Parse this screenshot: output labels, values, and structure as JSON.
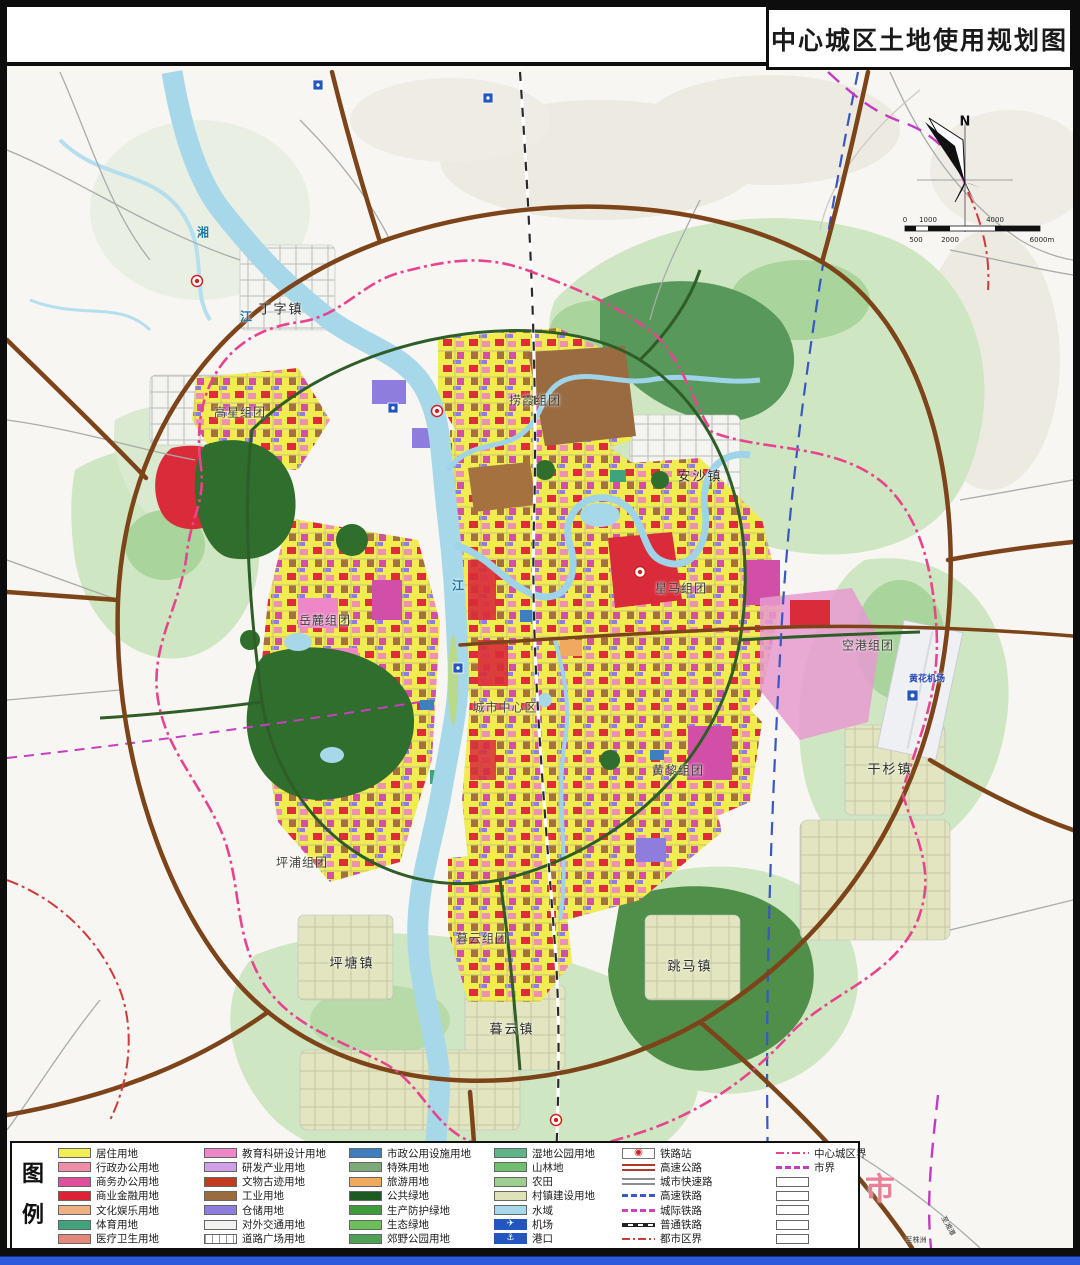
{
  "title": "中心城区土地使用规划图",
  "legend": {
    "heading": "图例",
    "columns": [
      {
        "items": [
          {
            "label": "居住用地",
            "swatch": "fill",
            "color": "#f2ef52"
          },
          {
            "label": "行政办公用地",
            "swatch": "fill",
            "color": "#ef8ea6"
          },
          {
            "label": "商务办公用地",
            "swatch": "fill",
            "color": "#e04f9e"
          },
          {
            "label": "商业金融用地",
            "swatch": "fill",
            "color": "#dd2235"
          },
          {
            "label": "文化娱乐用地",
            "swatch": "fill",
            "color": "#efb183"
          },
          {
            "label": "体育用地",
            "swatch": "fill",
            "color": "#3fa47c"
          },
          {
            "label": "医疗卫生用地",
            "swatch": "fill",
            "color": "#e4877d"
          }
        ]
      },
      {
        "items": [
          {
            "label": "教育科研设计用地",
            "swatch": "fill",
            "color": "#ee86c8"
          },
          {
            "label": "研发产业用地",
            "swatch": "fill",
            "color": "#cf9fe8"
          },
          {
            "label": "文物古迹用地",
            "swatch": "fill",
            "color": "#c23a20"
          },
          {
            "label": "工业用地",
            "swatch": "fill",
            "color": "#9a6b41"
          },
          {
            "label": "仓储用地",
            "swatch": "fill",
            "color": "#8f7ddd"
          },
          {
            "label": "对外交通用地",
            "swatch": "fill",
            "color": "#f2f2f0"
          },
          {
            "label": "道路广场用地",
            "swatch": "hatch",
            "color": "#f2f2f0"
          }
        ]
      },
      {
        "items": [
          {
            "label": "市政公用设施用地",
            "swatch": "fill",
            "color": "#3e7fc1"
          },
          {
            "label": "特殊用地",
            "swatch": "fill",
            "color": "#7da878"
          },
          {
            "label": "旅游用地",
            "swatch": "fill",
            "color": "#f0a95e"
          },
          {
            "label": "公共绿地",
            "swatch": "fill",
            "color": "#1e5b20"
          },
          {
            "label": "生产防护绿地",
            "swatch": "fill",
            "color": "#3f9c3a"
          },
          {
            "label": "生态绿地",
            "swatch": "fill",
            "color": "#6cbf57"
          },
          {
            "label": "郊野公园用地",
            "swatch": "fill",
            "color": "#4f9f55"
          }
        ]
      },
      {
        "items": [
          {
            "label": "湿地公园用地",
            "swatch": "fill",
            "color": "#5cb586"
          },
          {
            "label": "山林地",
            "swatch": "fill",
            "color": "#6fbf6f"
          },
          {
            "label": "农田",
            "swatch": "fill",
            "color": "#9ccf8f"
          },
          {
            "label": "村镇建设用地",
            "swatch": "fill",
            "color": "#dfe2b8"
          },
          {
            "label": "水域",
            "swatch": "fill",
            "color": "#a6d8ea"
          },
          {
            "label": "机场",
            "swatch": "icon-airport",
            "color": "#2456c0"
          },
          {
            "label": "港口",
            "swatch": "icon-port",
            "color": "#2456c0"
          }
        ]
      },
      {
        "items": [
          {
            "label": "铁路站",
            "swatch": "icon-station",
            "color": "#cc2222"
          },
          {
            "label": "高速公路",
            "swatch": "line-double",
            "color": "#b03a2e"
          },
          {
            "label": "城市快速路",
            "swatch": "line-double",
            "color": "#8a8f93"
          },
          {
            "label": "高速铁路",
            "swatch": "dash",
            "color": "#3a57c4"
          },
          {
            "label": "城际铁路",
            "swatch": "dash",
            "color": "#cc44bb"
          },
          {
            "label": "普通铁路",
            "swatch": "rail",
            "color": "#222222"
          },
          {
            "label": "都市区界",
            "swatch": "dashdot",
            "color": "#d03a3a"
          }
        ]
      },
      {
        "items": [
          {
            "label": "中心城区界",
            "swatch": "dashdot",
            "color": "#e8448e"
          },
          {
            "label": "市界",
            "swatch": "dash",
            "color": "#c23bc2"
          },
          {
            "label": "",
            "swatch": "empty",
            "color": "#ffffff"
          },
          {
            "label": "",
            "swatch": "empty",
            "color": "#ffffff"
          },
          {
            "label": "",
            "swatch": "empty",
            "color": "#ffffff"
          },
          {
            "label": "",
            "swatch": "empty",
            "color": "#ffffff"
          },
          {
            "label": "",
            "swatch": "empty",
            "color": "#ffffff"
          }
        ]
      }
    ]
  },
  "map_labels": [
    {
      "text": "丁字镇",
      "x": 281,
      "y": 308,
      "kind": "town"
    },
    {
      "text": "高星组团",
      "x": 240,
      "y": 412,
      "kind": "cluster"
    },
    {
      "text": "捞霞组团",
      "x": 535,
      "y": 400,
      "kind": "cluster"
    },
    {
      "text": "安沙镇",
      "x": 700,
      "y": 475,
      "kind": "town"
    },
    {
      "text": "岳麓组团",
      "x": 325,
      "y": 620,
      "kind": "cluster"
    },
    {
      "text": "星马组团",
      "x": 681,
      "y": 588,
      "kind": "cluster"
    },
    {
      "text": "城市中心区",
      "x": 505,
      "y": 707,
      "kind": "center"
    },
    {
      "text": "黄黎组团",
      "x": 678,
      "y": 770,
      "kind": "cluster"
    },
    {
      "text": "空港组团",
      "x": 868,
      "y": 645,
      "kind": "cluster"
    },
    {
      "text": "黄花机场",
      "x": 927,
      "y": 678,
      "kind": "airport"
    },
    {
      "text": "干杉镇",
      "x": 890,
      "y": 768,
      "kind": "town"
    },
    {
      "text": "坪浦组团",
      "x": 302,
      "y": 862,
      "kind": "cluster"
    },
    {
      "text": "暮云组团",
      "x": 482,
      "y": 938,
      "kind": "cluster"
    },
    {
      "text": "坪塘镇",
      "x": 352,
      "y": 962,
      "kind": "town"
    },
    {
      "text": "跳马镇",
      "x": 690,
      "y": 965,
      "kind": "town"
    },
    {
      "text": "暮云镇",
      "x": 512,
      "y": 1028,
      "kind": "town"
    },
    {
      "text": "湘",
      "x": 203,
      "y": 232,
      "kind": "river"
    },
    {
      "text": "江",
      "x": 246,
      "y": 316,
      "kind": "river"
    },
    {
      "text": "江",
      "x": 458,
      "y": 585,
      "kind": "river"
    },
    {
      "text": "市",
      "x": 880,
      "y": 1186,
      "kind": "city"
    },
    {
      "text": "N",
      "x": 965,
      "y": 122,
      "kind": "compass"
    },
    {
      "text": "0",
      "x": 905,
      "y": 220,
      "kind": "scale"
    },
    {
      "text": "1000",
      "x": 928,
      "y": 220,
      "kind": "scale"
    },
    {
      "text": "4000",
      "x": 995,
      "y": 220,
      "kind": "scale"
    },
    {
      "text": "500",
      "x": 916,
      "y": 240,
      "kind": "scale"
    },
    {
      "text": "2000",
      "x": 950,
      "y": 240,
      "kind": "scale"
    },
    {
      "text": "6000m",
      "x": 1042,
      "y": 240,
      "kind": "scale"
    },
    {
      "text": "至株洲",
      "x": 916,
      "y": 1240,
      "kind": "tiny"
    },
    {
      "text": "至湘潭",
      "x": 948,
      "y": 1226,
      "kind": "tiny",
      "r": 62
    }
  ],
  "colors": {
    "water": "#a6d8ea",
    "urban_yellow": "#f1ec50",
    "eco_green": "#cfe6c2",
    "forest_green": "#2f6e2c",
    "highway_brown": "#7d4419",
    "ring_road_green": "#2e5d28",
    "center_boundary_pink": "#e8448e",
    "city_boundary_magenta": "#c23bc2",
    "metro_boundary_red": "#d03a3a",
    "frame_black": "#0d0d0d",
    "bottom_strip_blue": "#2e59d9"
  }
}
